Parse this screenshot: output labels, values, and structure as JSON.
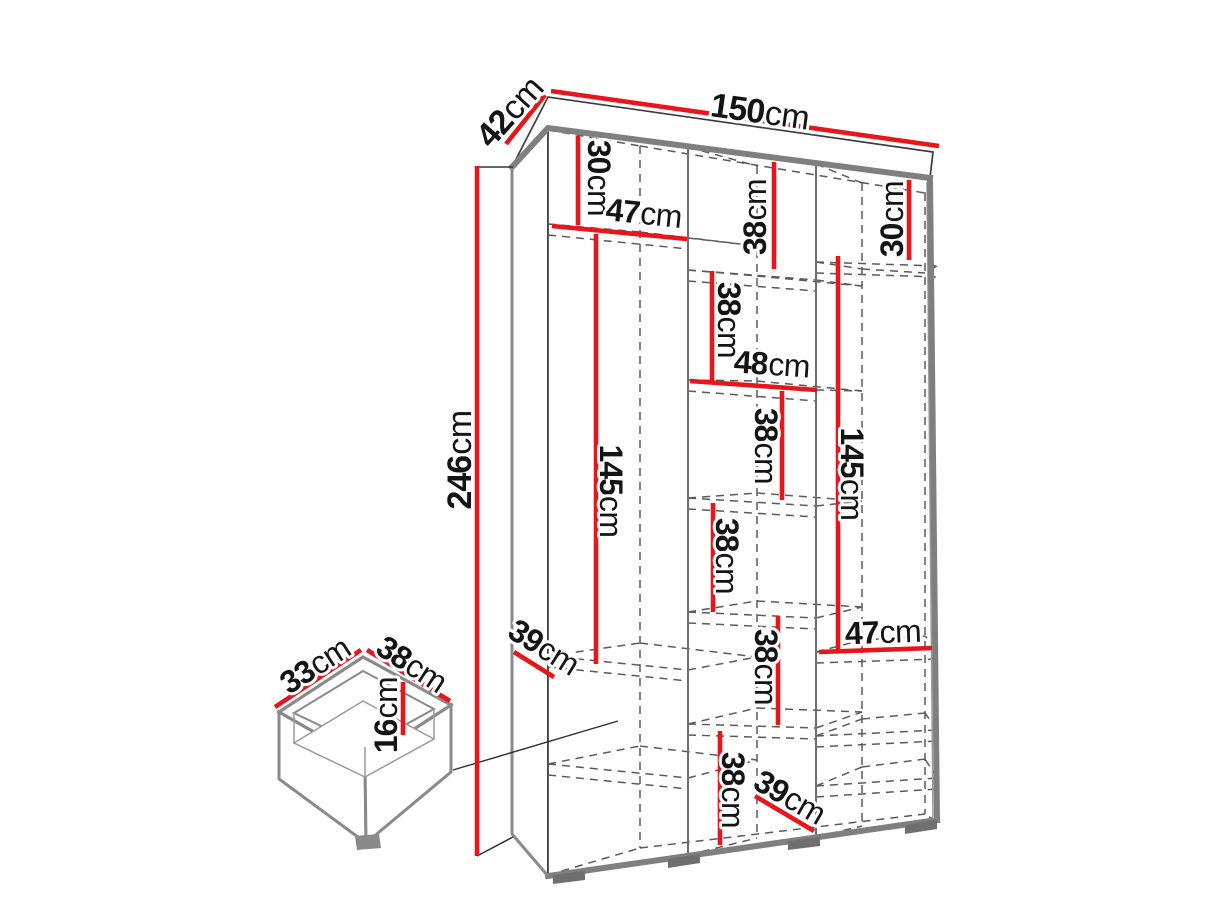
{
  "diagram_type": "furniture-dimension-drawing",
  "unit": "cm",
  "colors": {
    "dimension_line": "#e8161b",
    "outline": "#3d3d3d",
    "edge": "#7f7f7f",
    "text": "#141414",
    "background": "#ffffff"
  },
  "wardrobe": {
    "width_cm": 150,
    "depth_cm": 42,
    "height_cm": 246
  },
  "drawer_detail": {
    "width_cm": 33,
    "depth_cm": 38,
    "height_cm": 16
  },
  "labels": [
    {
      "id": "width-top",
      "value": "150",
      "unit": "cm"
    },
    {
      "id": "depth-top",
      "value": "42",
      "unit": "cm"
    },
    {
      "id": "height-left",
      "value": "246",
      "unit": "cm"
    },
    {
      "id": "left-top-section",
      "value": "30",
      "unit": "cm"
    },
    {
      "id": "left-shelf-width",
      "value": "47",
      "unit": "cm"
    },
    {
      "id": "middle-top-section",
      "value": "38",
      "unit": "cm"
    },
    {
      "id": "right-top-section",
      "value": "30",
      "unit": "cm"
    },
    {
      "id": "middle-section-2",
      "value": "38",
      "unit": "cm"
    },
    {
      "id": "middle-shelf-width",
      "value": "48",
      "unit": "cm"
    },
    {
      "id": "middle-section-3",
      "value": "38",
      "unit": "cm"
    },
    {
      "id": "left-hanging-section",
      "value": "145",
      "unit": "cm"
    },
    {
      "id": "right-hanging-section",
      "value": "145",
      "unit": "cm"
    },
    {
      "id": "middle-section-4",
      "value": "38",
      "unit": "cm"
    },
    {
      "id": "right-shelf-width",
      "value": "47",
      "unit": "cm"
    },
    {
      "id": "left-shelf-depth",
      "value": "39",
      "unit": "cm"
    },
    {
      "id": "middle-section-5",
      "value": "38",
      "unit": "cm"
    },
    {
      "id": "middle-bottom-section",
      "value": "38",
      "unit": "cm"
    },
    {
      "id": "bottom-shelf-depth",
      "value": "39",
      "unit": "cm"
    },
    {
      "id": "drawer-width",
      "value": "33",
      "unit": "cm"
    },
    {
      "id": "drawer-depth",
      "value": "38",
      "unit": "cm"
    },
    {
      "id": "drawer-height",
      "value": "16",
      "unit": "cm"
    }
  ]
}
